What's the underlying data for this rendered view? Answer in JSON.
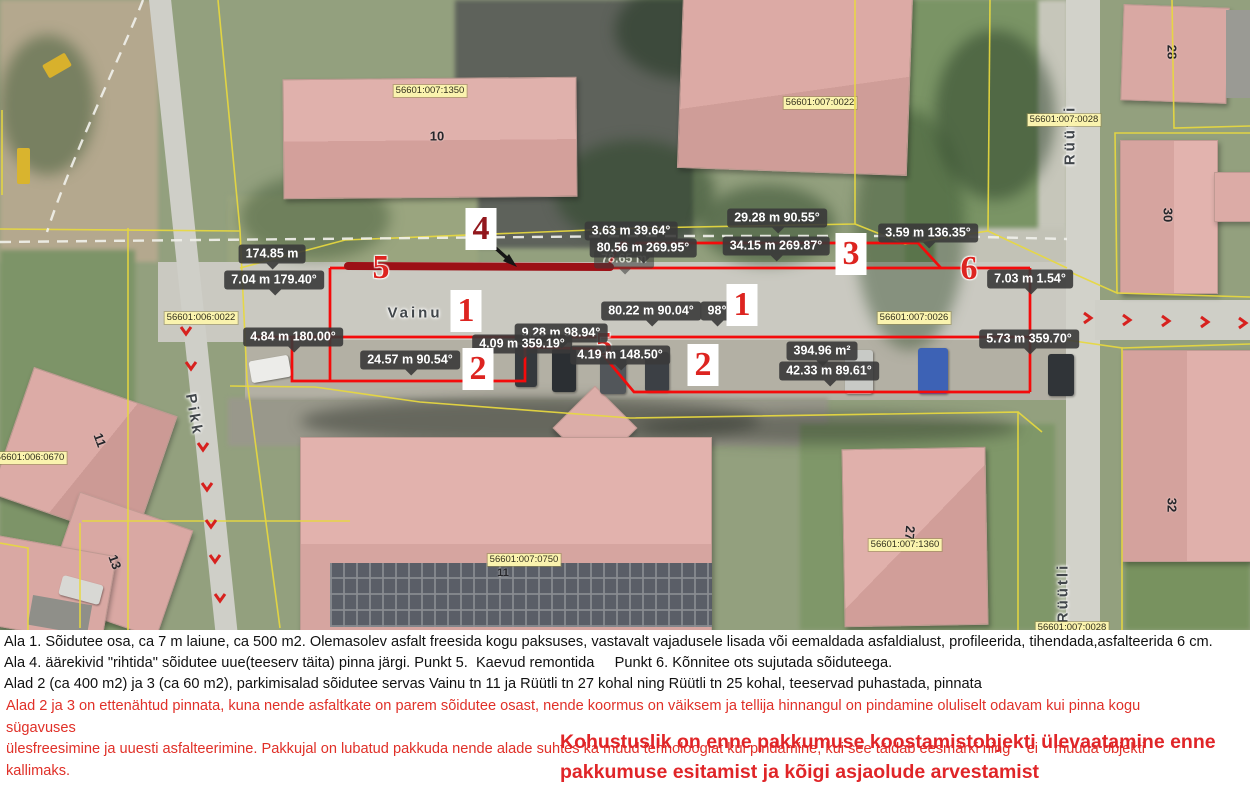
{
  "map": {
    "streets": {
      "vainu": "Vainu",
      "pikk": "Pikk",
      "ruutli_north": "Rüütli",
      "ruutli_south": "Rüütli"
    },
    "cadastral_parcels": [
      {
        "text": "56601:007:1350"
      },
      {
        "text": "56601:007:0022"
      },
      {
        "text": "56601:007:0028"
      },
      {
        "text": "56601:006:0022"
      },
      {
        "text": "56601:007:0026"
      },
      {
        "text": "56601:006:0670"
      },
      {
        "text": "56601:007:0750"
      },
      {
        "text": "56601:007:1360"
      },
      {
        "text": "56601:007:0028"
      }
    ],
    "house_numbers": [
      {
        "text": "10"
      },
      {
        "text": "28"
      },
      {
        "text": "30"
      },
      {
        "text": "32"
      },
      {
        "text": "27"
      },
      {
        "text": "11"
      },
      {
        "text": "13"
      },
      {
        "text": "11"
      }
    ],
    "area_markers": [
      {
        "text": "1"
      },
      {
        "text": "1"
      },
      {
        "text": "2"
      },
      {
        "text": "2"
      },
      {
        "text": "3"
      },
      {
        "text": "4"
      },
      {
        "text": "5"
      },
      {
        "text": "5"
      },
      {
        "text": "6"
      }
    ],
    "measurements": [
      {
        "text": "174.85 m"
      },
      {
        "text": "7.04 m 179.40°"
      },
      {
        "text": "4.84 m 180.00°"
      },
      {
        "text": "24.57 m 90.54°"
      },
      {
        "text": "9.28 m 98.94°"
      },
      {
        "text": "4.09 m 359.19°"
      },
      {
        "text": "4.19 m 148.50°"
      },
      {
        "text": "80.22 m 90.04°"
      },
      {
        "text": "3.63 m 39.64°"
      },
      {
        "text": "80.56 m 269.95°"
      },
      {
        "text": "34.15 m 269.87°"
      },
      {
        "text": "29.28 m 90.55°"
      },
      {
        "text": "3.59 m 136.35°"
      },
      {
        "text": "394.96 m²"
      },
      {
        "text": "42.33 m 89.61°"
      },
      {
        "text": "5.73 m 359.70°"
      },
      {
        "text": "7.03 m 1.54°"
      }
    ],
    "ghost_measurements": [
      {
        "text": "78.65 m"
      },
      {
        "text": "98°"
      }
    ]
  },
  "notes": {
    "line1": "Ala 1. Sõidutee osa, ca 7 m laiune, ca 500 m2. Olemasolev asfalt freesida kogu paksuses, vastavalt vajadusele lisada või eemaldada asfaldialust, profileerida, tihendada,asfalteerida 6 cm.",
    "line2": "Ala 4. äärekivid \"rihtida\" sõidutee uue(teeserv täita) pinna järgi. Punkt 5.  Kaevud remontida     Punkt 6. Kõnnitee ots sujutada sõiduteega.",
    "line3": "Alad 2 (ca 400 m2) ja 3 (ca 60 m2), parkimisalad sõidutee servas Vainu tn 11 ja Rüütli tn 27 kohal ning Rüütli tn 25 kohal, teeservad puhastada, pinnata",
    "red_paragraph": "Alad 2 ja 3 on ettenähtud pinnata, kuna nende asfaltkate on parem sõidutee osast, nende koormus on väiksem ja tellija hinnangul on pindamine oluliselt odavam kui pinna kogu sügavuses\nülesfreesimine ja uuesti asfalteerimine. Pakkujal on lubatud pakkuda nende alade suhtes ka muud tehnoloogiat kui pindamine, kui see täidab eesmärki ning    ei    muuda objekti kallimaks.",
    "red_small": "Kõik tööd teha hea tava kohaselt, vältida veeloikude tekkimine momg tagada tasasus.",
    "warning": "Kohustuslik on enne pakkumuse koostamistobjekti ülevaatamine enne\npakkumuse esitamist ja kõigi asjaolude arvestamist"
  },
  "colors": {
    "red_line": "#f40b0b",
    "dark_red_bar": "#9c1016",
    "label_bg": "#3a3a3a",
    "cadastral_bg": "#faf3ae",
    "marker_red": "#dd2420",
    "yellow_line": "#e8d93f",
    "warning_red": "#e02528"
  }
}
